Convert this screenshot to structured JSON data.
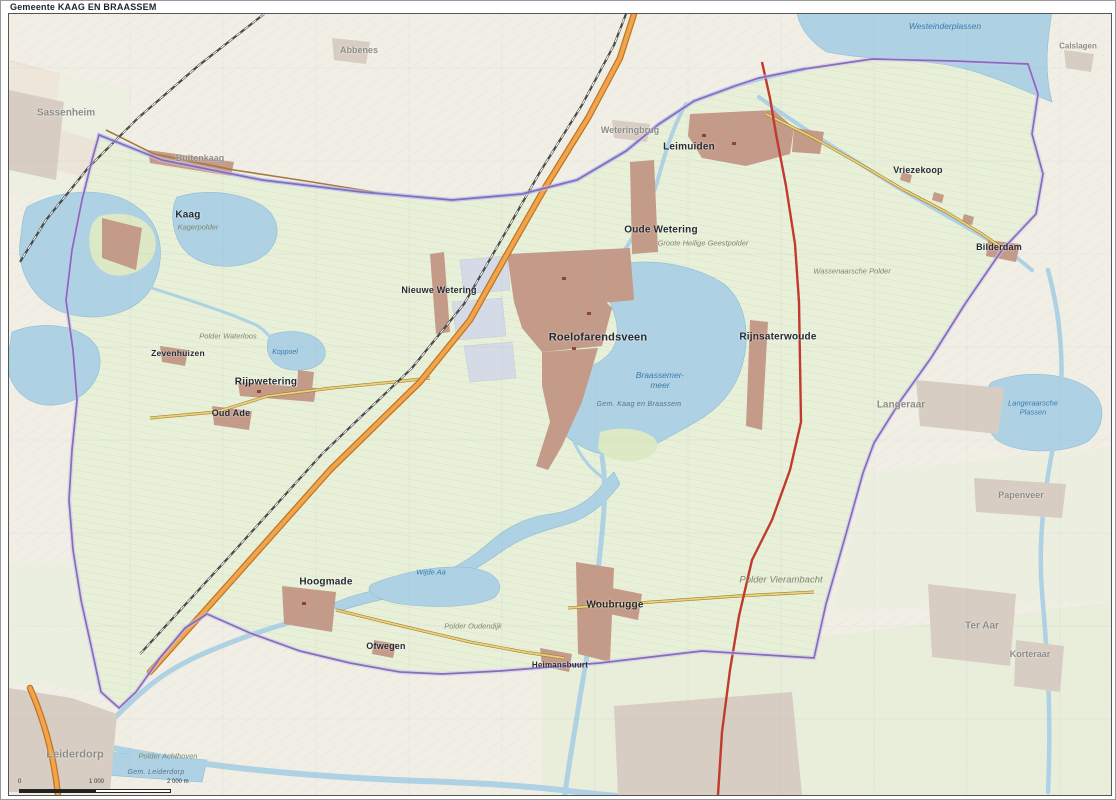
{
  "title": "Gemeente KAAG EN BRAASSEM",
  "map": {
    "scalebar": {
      "start": "0",
      "mid": "1 000",
      "end": "2 000 m"
    },
    "colors": {
      "water": "#aed1e4",
      "water_line": "#8fbcd4",
      "municipality_fill": "#e9f0da",
      "outside_fill": "#f1efe5",
      "boundary": "#8166bd",
      "built_up": "#c49a89",
      "built_up_outside": "#d8cdc3",
      "motorway": "#f2a44a",
      "n_road": "#c03a2e",
      "local_road": "#ecd27c",
      "railway": "#4a4a4a",
      "town_label": "#262a33",
      "town_label_outside": "#8d8d88",
      "water_label": "#3a7cab",
      "polder_label": "#7d8670"
    },
    "labels": [
      {
        "id": "leimuiden",
        "text": "Leimuiden",
        "x": 687,
        "y": 145,
        "kind": "town-in"
      },
      {
        "id": "oude-wetering",
        "text": "Oude Wetering",
        "x": 659,
        "y": 228,
        "kind": "town-in"
      },
      {
        "id": "nieuwe-wetering",
        "text": "Nieuwe Wetering",
        "x": 437,
        "y": 288,
        "kind": "town-in",
        "size": 9
      },
      {
        "id": "roelofarendsveen",
        "text": "Roelofarendsveen",
        "x": 596,
        "y": 336,
        "kind": "town-in",
        "size": 11
      },
      {
        "id": "rijnsaterwoude",
        "text": "Rijnsaterwoude",
        "x": 776,
        "y": 335,
        "kind": "town-in"
      },
      {
        "id": "bilderdam",
        "text": "Bilderdam",
        "x": 997,
        "y": 245,
        "kind": "town-in",
        "size": 9
      },
      {
        "id": "vriezekoop",
        "text": "Vriezekoop",
        "x": 916,
        "y": 168,
        "kind": "town-in",
        "size": 9
      },
      {
        "id": "kaag",
        "text": "Kaag",
        "x": 186,
        "y": 213,
        "kind": "town-in"
      },
      {
        "id": "zevenhuizen",
        "text": "Zevenhuizen",
        "x": 176,
        "y": 352,
        "kind": "town-in",
        "size": 8.5
      },
      {
        "id": "rijpwetering",
        "text": "Rijpwetering",
        "x": 264,
        "y": 380,
        "kind": "town-in"
      },
      {
        "id": "oud-ade",
        "text": "Oud Ade",
        "x": 229,
        "y": 411,
        "kind": "town-in",
        "size": 9
      },
      {
        "id": "hoogmade",
        "text": "Hoogmade",
        "x": 324,
        "y": 580,
        "kind": "town-in"
      },
      {
        "id": "ofwegen",
        "text": "Ofwegen",
        "x": 384,
        "y": 644,
        "kind": "town-in",
        "size": 9
      },
      {
        "id": "woubrugge",
        "text": "Woubrugge",
        "x": 613,
        "y": 603,
        "kind": "town-in"
      },
      {
        "id": "heimansbuurt",
        "text": "Heimansbuurt",
        "x": 558,
        "y": 663,
        "kind": "town-in",
        "size": 8
      },
      {
        "id": "sassenheim",
        "text": "Sassenheim",
        "x": 64,
        "y": 111,
        "kind": "town-out"
      },
      {
        "id": "abbenes",
        "text": "Abbenes",
        "x": 357,
        "y": 48,
        "kind": "town-out",
        "size": 9
      },
      {
        "id": "weteringbrug",
        "text": "Weteringbrug",
        "x": 628,
        "y": 128,
        "kind": "town-out",
        "size": 9
      },
      {
        "id": "buitenkaag",
        "text": "Buitenkaag",
        "x": 198,
        "y": 156,
        "kind": "town-out",
        "size": 9
      },
      {
        "id": "calslagen",
        "text": "Calslagen",
        "x": 1076,
        "y": 44,
        "kind": "town-out",
        "size": 8
      },
      {
        "id": "langeraar",
        "text": "Langeraar",
        "x": 899,
        "y": 403,
        "kind": "town-out"
      },
      {
        "id": "papenveer",
        "text": "Papenveer",
        "x": 1019,
        "y": 493,
        "kind": "town-out",
        "size": 9
      },
      {
        "id": "ter-aar",
        "text": "Ter Aar",
        "x": 980,
        "y": 624,
        "kind": "town-out"
      },
      {
        "id": "korteraar",
        "text": "Korteraar",
        "x": 1028,
        "y": 652,
        "kind": "town-out",
        "size": 9
      },
      {
        "id": "leiderdorp",
        "text": "Leiderdorp",
        "x": 73,
        "y": 753,
        "kind": "town-out",
        "size": 11
      },
      {
        "id": "westeinderplassen",
        "text": "Westeinderplassen",
        "x": 943,
        "y": 25,
        "kind": "water"
      },
      {
        "id": "braassemermeer",
        "text": "Braassemer-\nmeer",
        "x": 658,
        "y": 379,
        "kind": "water"
      },
      {
        "id": "koppoel",
        "text": "Koppoel",
        "x": 283,
        "y": 351,
        "kind": "water",
        "size": 7
      },
      {
        "id": "wijde-aa",
        "text": "Wijde Aa",
        "x": 429,
        "y": 571,
        "kind": "water",
        "size": 7.5
      },
      {
        "id": "langeraarsche-plassen",
        "text": "Langeraarsche\nPlassen",
        "x": 1031,
        "y": 406,
        "kind": "water",
        "size": 7.5
      },
      {
        "id": "polder-waterloos",
        "text": "Polder Waterloos",
        "x": 226,
        "y": 335,
        "kind": "polder"
      },
      {
        "id": "kagerpolder",
        "text": "Kagerpolder",
        "x": 196,
        "y": 226,
        "kind": "polder"
      },
      {
        "id": "groote-heilige-geestpolder",
        "text": "Groote Heilige Geestpolder",
        "x": 701,
        "y": 242,
        "kind": "polder"
      },
      {
        "id": "wassenaarsche-polder",
        "text": "Wassenaarsche Polder",
        "x": 850,
        "y": 270,
        "kind": "polder"
      },
      {
        "id": "polder-oudendijk",
        "text": "Polder Oudendijk",
        "x": 471,
        "y": 625,
        "kind": "polder"
      },
      {
        "id": "polder-vierambacht",
        "text": "Polder Vierambacht",
        "x": 779,
        "y": 579,
        "kind": "polder",
        "size": 9.5
      },
      {
        "id": "polder-achthoven",
        "text": "Polder Achthoven",
        "x": 166,
        "y": 755,
        "kind": "polder"
      },
      {
        "id": "gem-kaag-en-braassem",
        "text": "Gem. Kaag en Braassem",
        "x": 637,
        "y": 403,
        "kind": "admin"
      },
      {
        "id": "gem-leiderdorp",
        "text": "Gem. Leiderdorp",
        "x": 154,
        "y": 771,
        "kind": "admin"
      }
    ]
  }
}
